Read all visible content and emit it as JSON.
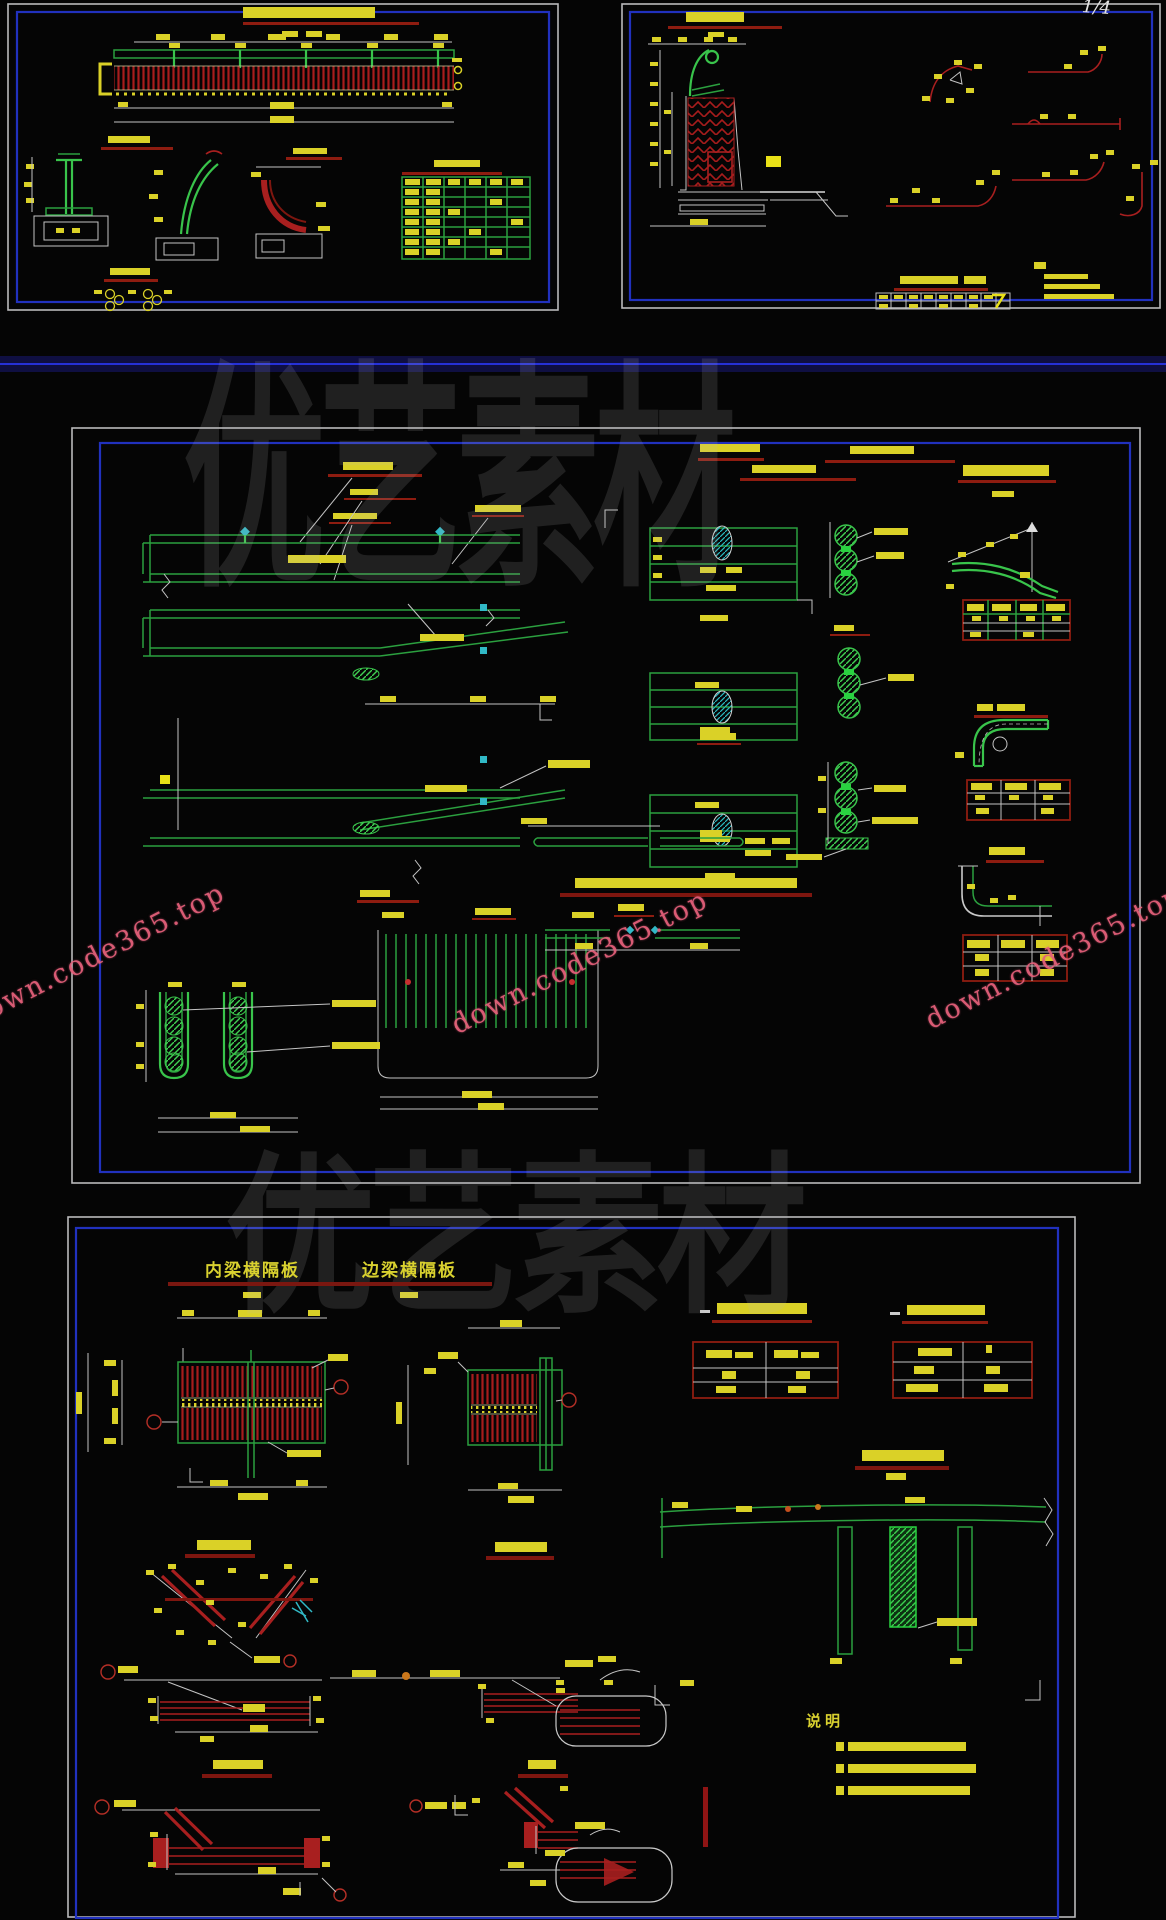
{
  "canvas": {
    "width": 1166,
    "height": 1920,
    "background": "#050505"
  },
  "palette": {
    "cad_yellow": "#d9d12f",
    "cad_green": "#2f9e42",
    "cad_green_bright": "#3ed455",
    "cad_red": "#a32020",
    "underline_red": "#8a1d12",
    "underline_brown": "#7a1710",
    "dim_gray": "#c4c4c4",
    "accent_cyan": "#36b8c4",
    "frame_blue": "#2231b8",
    "frame_white": "#b9b9bb",
    "highlight_yellow": "#e8e020",
    "watermark_pink": "#e4607a",
    "watermark_gray": "rgba(190,190,190,0.15)"
  },
  "page_label": "1/4",
  "watermarks": {
    "brand": {
      "text": "优艺素材",
      "occurrences": 2
    },
    "url": {
      "text": "down.code365.top",
      "occurrences": 3
    }
  },
  "bottom_sheet": {
    "title_inner_diaphragm": "内梁横隔板",
    "title_edge_diaphragm": "边梁横隔板",
    "notes_heading": "说明",
    "notes_count": 3
  }
}
